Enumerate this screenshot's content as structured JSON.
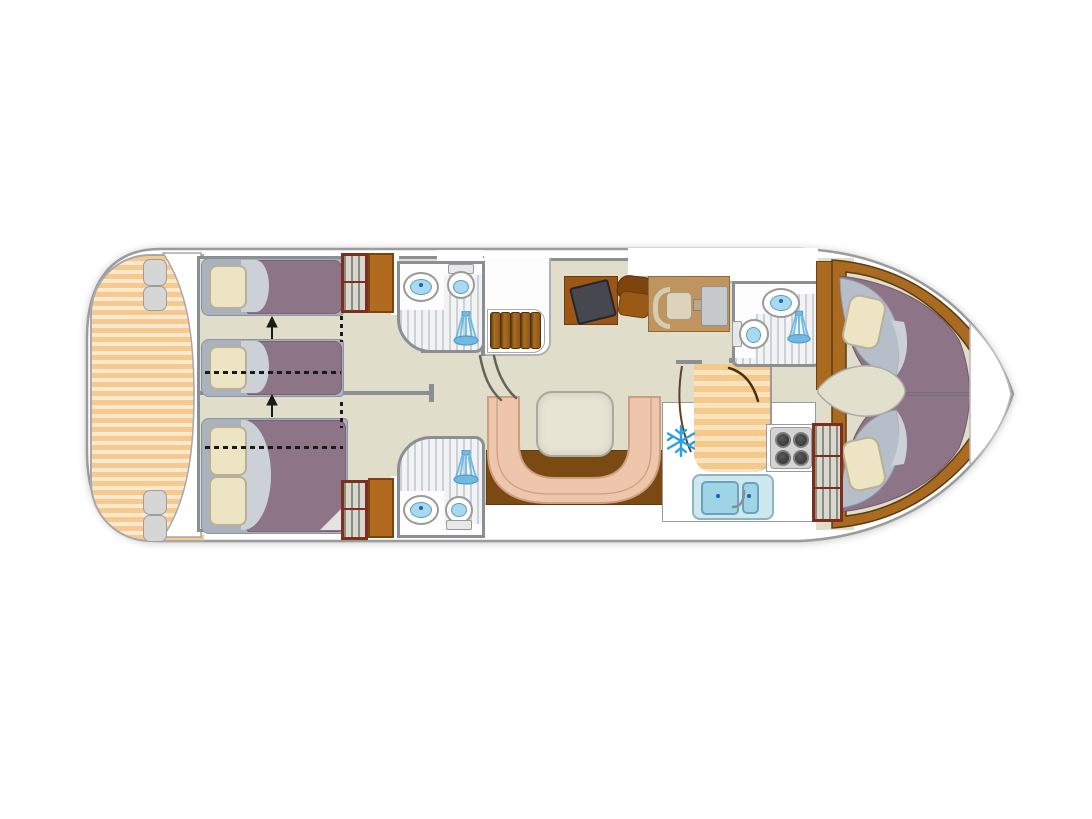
{
  "meta": {
    "description": "Top-down floor plan of a canal cruising houseboat, bow pointing right",
    "view": "plan view"
  },
  "colors": {
    "hull-outline": "#9b9b9b",
    "deck-stripe-a": "#f6c98f",
    "deck-stripe-b": "#fbe8cf",
    "floor": "#e0decb",
    "wall": "#8b8f94",
    "wood": "#b06b1f",
    "wood-dark": "#5c3a12",
    "step-brown": "#8a5518",
    "step-brown-l": "#a96f1f",
    "bed-blanket": "#8d7486",
    "bed-base": "#a9b2bd",
    "pillow": "#ece4c3",
    "pillow-border": "#b8b09a",
    "fold": "#ccd1d8",
    "headboard": "#b5bec9",
    "wardrobe-frame": "#7c2f1e",
    "wardrobe-panel": "#d9d8d0",
    "tile-stripe": "#ccd1d6",
    "tile-bg": "#f1f3f5",
    "water-blue": "#a8d9ee",
    "fixture-border": "#9a9a9a",
    "shower-blue": "#6fb9e2",
    "shower-blue-dark": "#4f9cc8",
    "sofa": "#eec6ab",
    "sofa-edge": "#cf9e80",
    "table": "#e8e4d3",
    "tv": "#474750",
    "tv-cabinet": "#9c5716",
    "helm-platform": "#c0945e",
    "seat-tan": "#ddd3bd",
    "console-gray": "#c6c9cc",
    "snowflake-blue": "#2aa0e8",
    "stove-burner": "#2e2e2e",
    "sink-blue": "#9ed4e6",
    "sink-frame": "#cde8ee",
    "galley-stripe-a": "#f4c98c",
    "galley-stripe-b": "#f9e2bd",
    "bow-trim": "#aa6a20",
    "leaf-floor": "#e2e0cc",
    "arrow-black": "#1a1a1a",
    "sofa-floor-wood": "#7a4a12"
  },
  "rooms": [
    {
      "id": "aft-deck",
      "label": "aft deck",
      "features": [
        "slatted-deck-floor",
        "transom-steps"
      ]
    },
    {
      "id": "aft-cabin-top",
      "label": "aft cabin (top)",
      "features": [
        "single-bed",
        "single-bed",
        "sliding-bed-arrow",
        "dashed-convert-lines",
        "wardrobe"
      ]
    },
    {
      "id": "aft-cabin-bottom",
      "label": "aft cabin (bottom)",
      "features": [
        "double-bed",
        "sliding-bed-arrow",
        "dashed-convert-lines",
        "wardrobe"
      ]
    },
    {
      "id": "bathroom-aft-top",
      "label": "shower room (aft, top)",
      "features": [
        "washbasin",
        "toilet",
        "shower"
      ]
    },
    {
      "id": "bathroom-aft-bottom",
      "label": "shower room (aft, bottom)",
      "features": [
        "washbasin",
        "toilet",
        "shower"
      ]
    },
    {
      "id": "companionway",
      "label": "steps down to aft cabins",
      "features": [
        "five-steps",
        "curved-handrails"
      ]
    },
    {
      "id": "saloon",
      "label": "saloon",
      "features": [
        "u-shaped-sofa",
        "dining-table",
        "tv-cabinet",
        "armchair"
      ]
    },
    {
      "id": "helm",
      "label": "inside steering position",
      "features": [
        "pilot-seat",
        "steering-console"
      ]
    },
    {
      "id": "galley",
      "label": "galley",
      "features": [
        "refrigerator",
        "four-burner-hob",
        "double-sink",
        "wardrobe",
        "door-swing"
      ]
    },
    {
      "id": "bathroom-forward",
      "label": "shower room (bow)",
      "features": [
        "washbasin",
        "toilet",
        "shower"
      ]
    },
    {
      "id": "bow-cabin",
      "label": "bow cabin",
      "features": [
        "v-shaped-double-bed",
        "pillow",
        "pillow",
        "center-floor"
      ]
    },
    {
      "id": "bow-deck",
      "label": "bow deck",
      "features": []
    }
  ],
  "counts": {
    "steps": 5,
    "burners": 4,
    "bathrooms": 3,
    "beds_aft_single": 2,
    "beds_aft_double": 1,
    "bow_berths": 2,
    "wardrobes": 3
  },
  "icons": [
    {
      "name": "snowflake-icon",
      "meaning": "refrigerator/freezer"
    },
    {
      "name": "shower-icon",
      "meaning": "shower"
    },
    {
      "name": "arrow-up-icon",
      "meaning": "sliding / convertible bed"
    }
  ]
}
